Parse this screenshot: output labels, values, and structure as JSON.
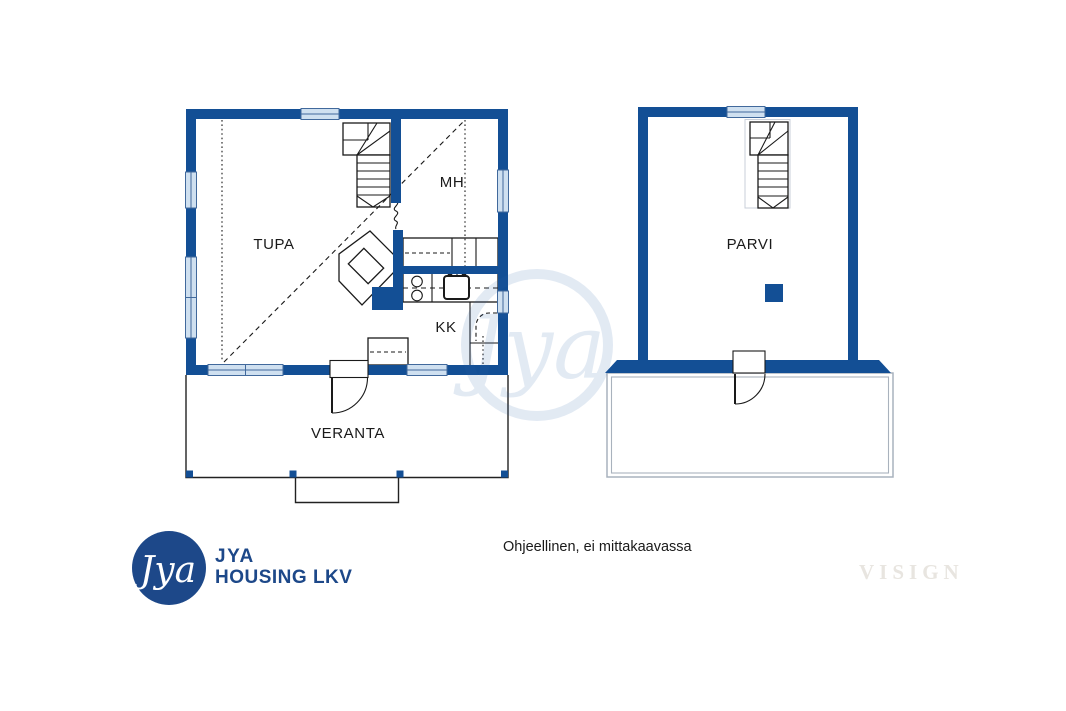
{
  "colors": {
    "wall_blue": "#134f95",
    "window_fill": "#cfe0f0",
    "window_border": "#41699c",
    "line_dark": "#1a1a1a",
    "balcony_line": "#a9b2bd",
    "watermark_blue": "#2a62ab",
    "logo_navy": "#1d4889",
    "visign_gray": "#e8e5e0"
  },
  "ground_floor": {
    "rooms": [
      {
        "label": "TUPA"
      },
      {
        "label": "MH"
      },
      {
        "label": "KK"
      },
      {
        "label": "VERANTA"
      }
    ]
  },
  "upper_floor": {
    "rooms": [
      {
        "label": "PARVI"
      }
    ]
  },
  "footer": {
    "logo_monogram": "Jya",
    "logo_line1": "JYA",
    "logo_line2": "HOUSING LKV",
    "disclaimer": "Ohjeellinen, ei mittakaavassa"
  },
  "watermarks": {
    "center_monogram": "Jya",
    "visign": "VISIGN"
  }
}
